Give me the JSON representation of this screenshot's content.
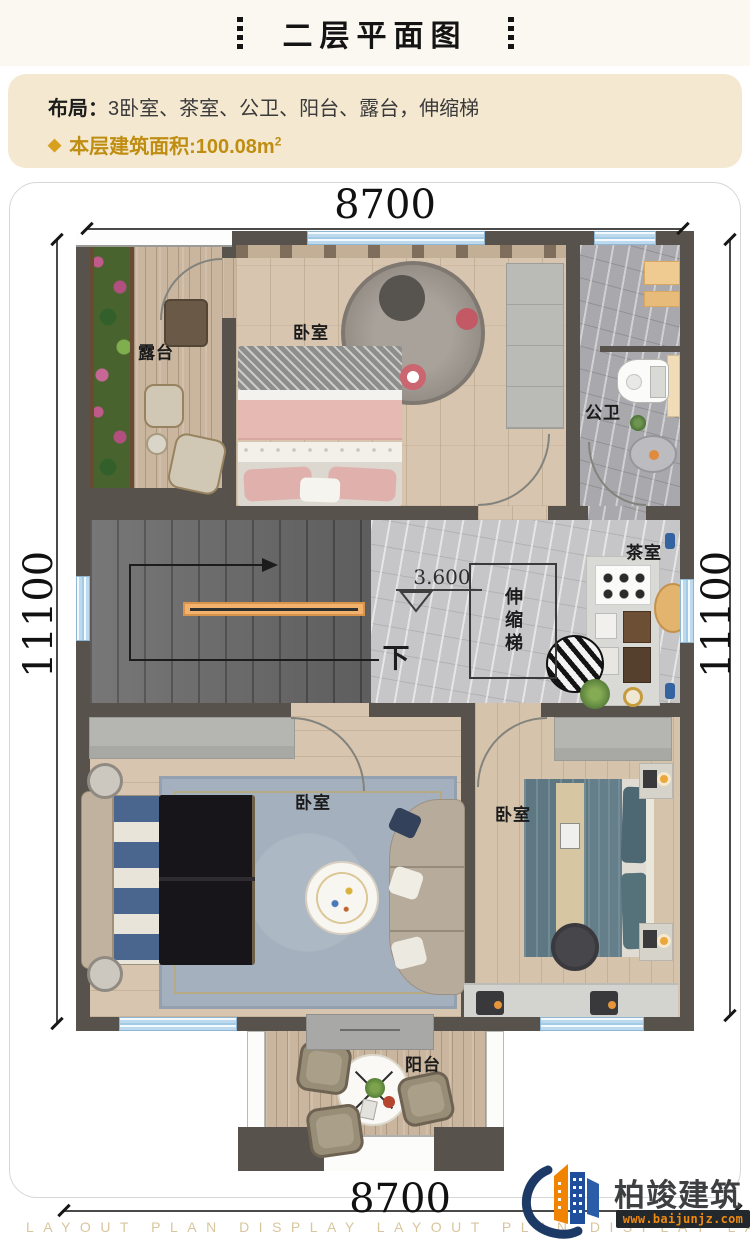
{
  "header": {
    "title": "二层平面图"
  },
  "info": {
    "layout_label": "布局：",
    "layout_value": "3卧室、茶室、公卫、阳台、露台，伸缩梯",
    "area_bullet": "◆",
    "area_text": "本层建筑面积:100.08m",
    "area_sup": "2"
  },
  "dimensions": {
    "top": "8700",
    "bottom": "8700",
    "left": "11100",
    "right": "11100"
  },
  "rooms": {
    "terrace": "露台",
    "bedroom_top": "卧室",
    "bathroom": "公卫",
    "tea_room": "茶室",
    "retractable_stair": "伸缩梯",
    "bedroom_left": "卧室",
    "bedroom_right": "卧室",
    "balcony": "阳台"
  },
  "plan": {
    "elevation": "3.600",
    "down": "下"
  },
  "footer": {
    "watermark": "LAYOUT PLAN DISPLAY LAYOUT PLAN DISPLAY LAYOUT PLAN DISPLAY"
  },
  "logo": {
    "name": "柏竣建筑",
    "site": "www.baijunjz.com"
  },
  "colors": {
    "accent_gold": "#bf8d12",
    "wall": "#57534c",
    "window": "#bcd9ee",
    "infobox": "#f4e9d0",
    "watermark": "#d8c69e",
    "logo_blue": "#1f4f9c",
    "logo_orange": "#f08300"
  }
}
